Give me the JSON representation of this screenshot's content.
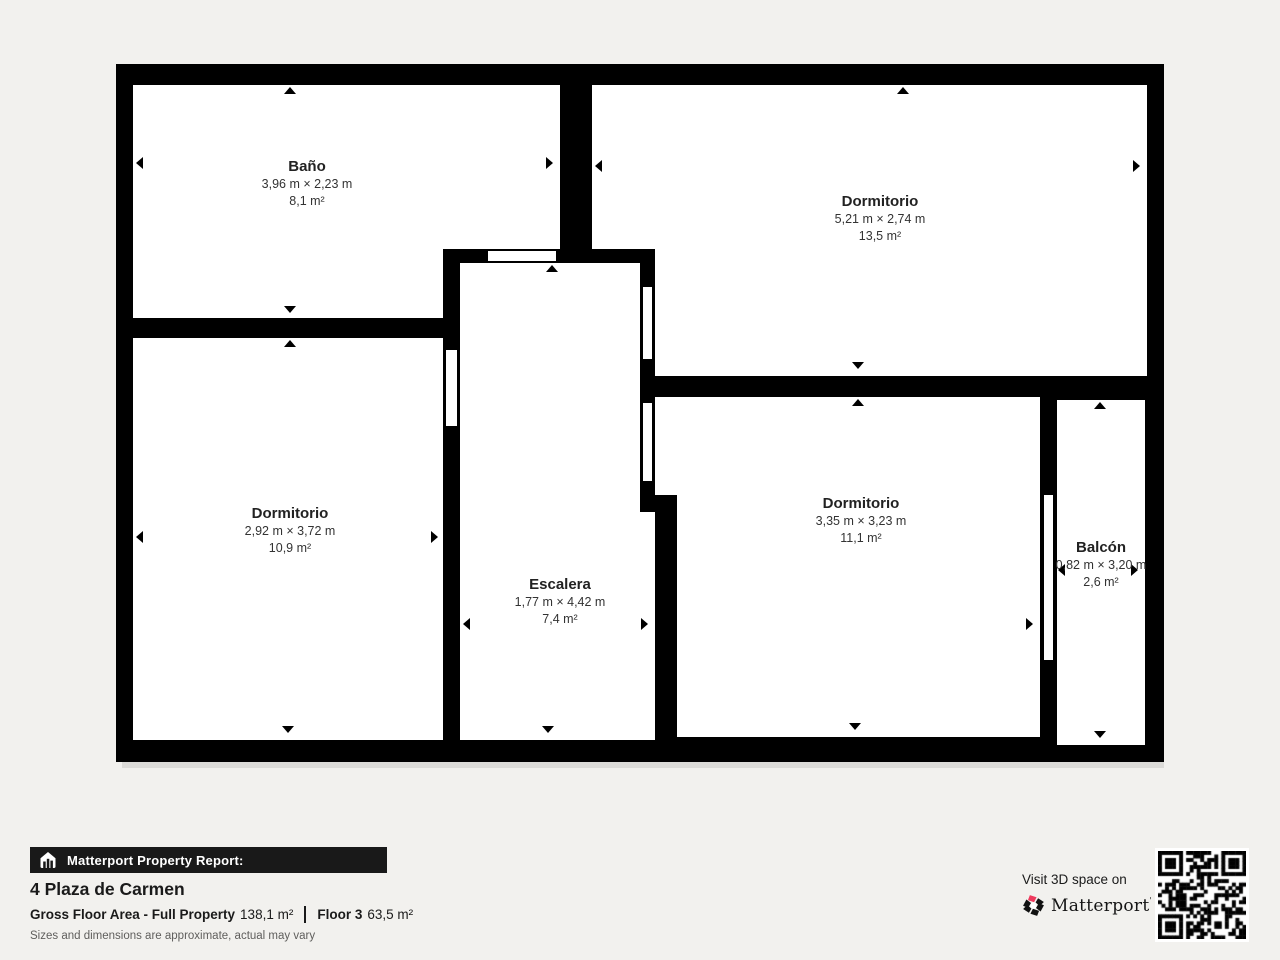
{
  "colors": {
    "background": "#f2f1ee",
    "wall": "#000000",
    "room_fill": "#ffffff",
    "banner_bg": "#191919",
    "brand_accent": "#ee3a5d"
  },
  "rooms": [
    {
      "id": "bano",
      "name": "Baño",
      "dimensions": "3,96 m × 2,23 m",
      "area": "8,1 m²"
    },
    {
      "id": "dormitorio-1",
      "name": "Dormitorio",
      "dimensions": "5,21 m × 2,74 m",
      "area": "13,5 m²"
    },
    {
      "id": "dormitorio-2",
      "name": "Dormitorio",
      "dimensions": "2,92 m × 3,72 m",
      "area": "10,9 m²"
    },
    {
      "id": "escalera",
      "name": "Escalera",
      "dimensions": "1,77 m × 4,42 m",
      "area": "7,4 m²"
    },
    {
      "id": "dormitorio-3",
      "name": "Dormitorio",
      "dimensions": "3,35 m × 3,23 m",
      "area": "11,1 m²"
    },
    {
      "id": "balcon",
      "name": "Balcón",
      "dimensions": "0,82 m × 3,20 m",
      "area": "2,6 m²"
    }
  ],
  "footer": {
    "report_label": "Matterport Property Report:",
    "address": "4 Plaza de Carmen",
    "gross_floor_area_label": "Gross Floor Area - Full Property",
    "gross_floor_area_value": "138,1 m²",
    "floor_label": "Floor 3",
    "floor_area_value": "63,5 m²",
    "disclaimer": "Sizes and dimensions are approximate, actual may vary",
    "visit_label": "Visit 3D space on",
    "brand": "Matterport",
    "brand_mark": "'"
  }
}
